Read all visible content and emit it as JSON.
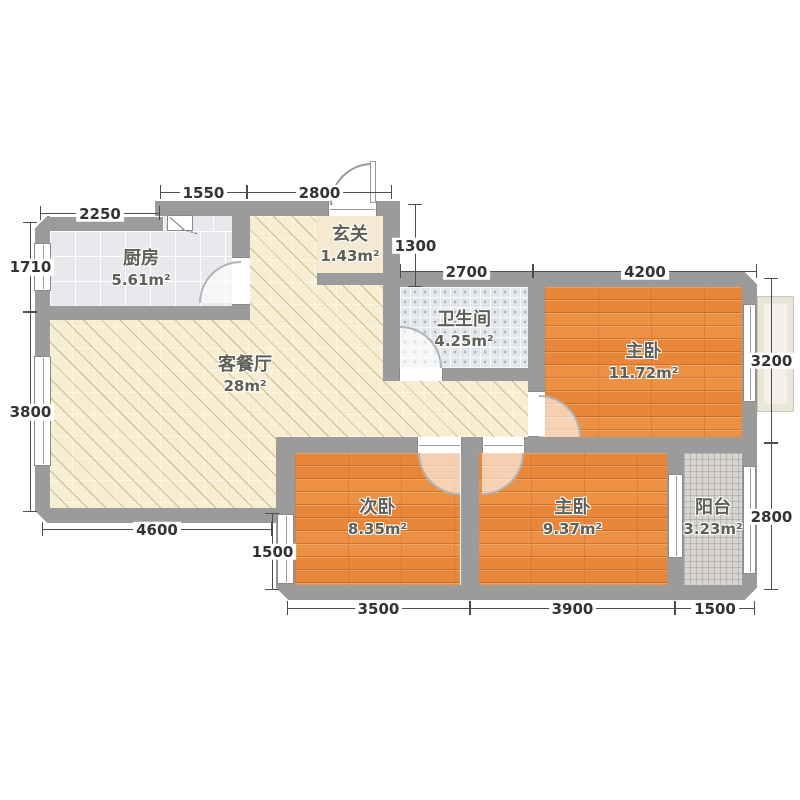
{
  "rooms": {
    "kitchen": {
      "name": "厨房",
      "area": "5.61m²"
    },
    "living": {
      "name": "客餐厅",
      "area": "28m²"
    },
    "entry": {
      "name": "玄关",
      "area": "1.43m²"
    },
    "bath": {
      "name": "卫生间",
      "area": "4.25m²"
    },
    "master_top": {
      "name": "主卧",
      "area": "11.72m²"
    },
    "second": {
      "name": "次卧",
      "area": "8.35m²"
    },
    "master_bottom": {
      "name": "主卧",
      "area": "9.37m²"
    },
    "balcony": {
      "name": "阳台",
      "area": "3.23m²"
    }
  },
  "dims": {
    "top_left": "2250",
    "top_mid": "1550",
    "top_entry": "2800",
    "entry_depth": "1300",
    "bath_top": "2700",
    "master_top_width": "4200",
    "left_upper": "1710",
    "left_lower": "3800",
    "right_upper": "3200",
    "right_lower": "2800",
    "bottom_living": "4600",
    "second_side": "1500",
    "bottom_second": "3500",
    "bottom_master": "3900",
    "bottom_balcony": "1500"
  },
  "colors": {
    "wall": "#9b9b9b",
    "wood_floor": "#e8883c",
    "living_floor": "#f7eed2",
    "kitchen_floor": "#e9e9ed",
    "bath_floor": "#e2e6ea",
    "balcony_floor": "#d8d5d0",
    "entry_floor": "#f5e9d1",
    "dim_text": "#333333",
    "room_label": "#5f5f58"
  }
}
